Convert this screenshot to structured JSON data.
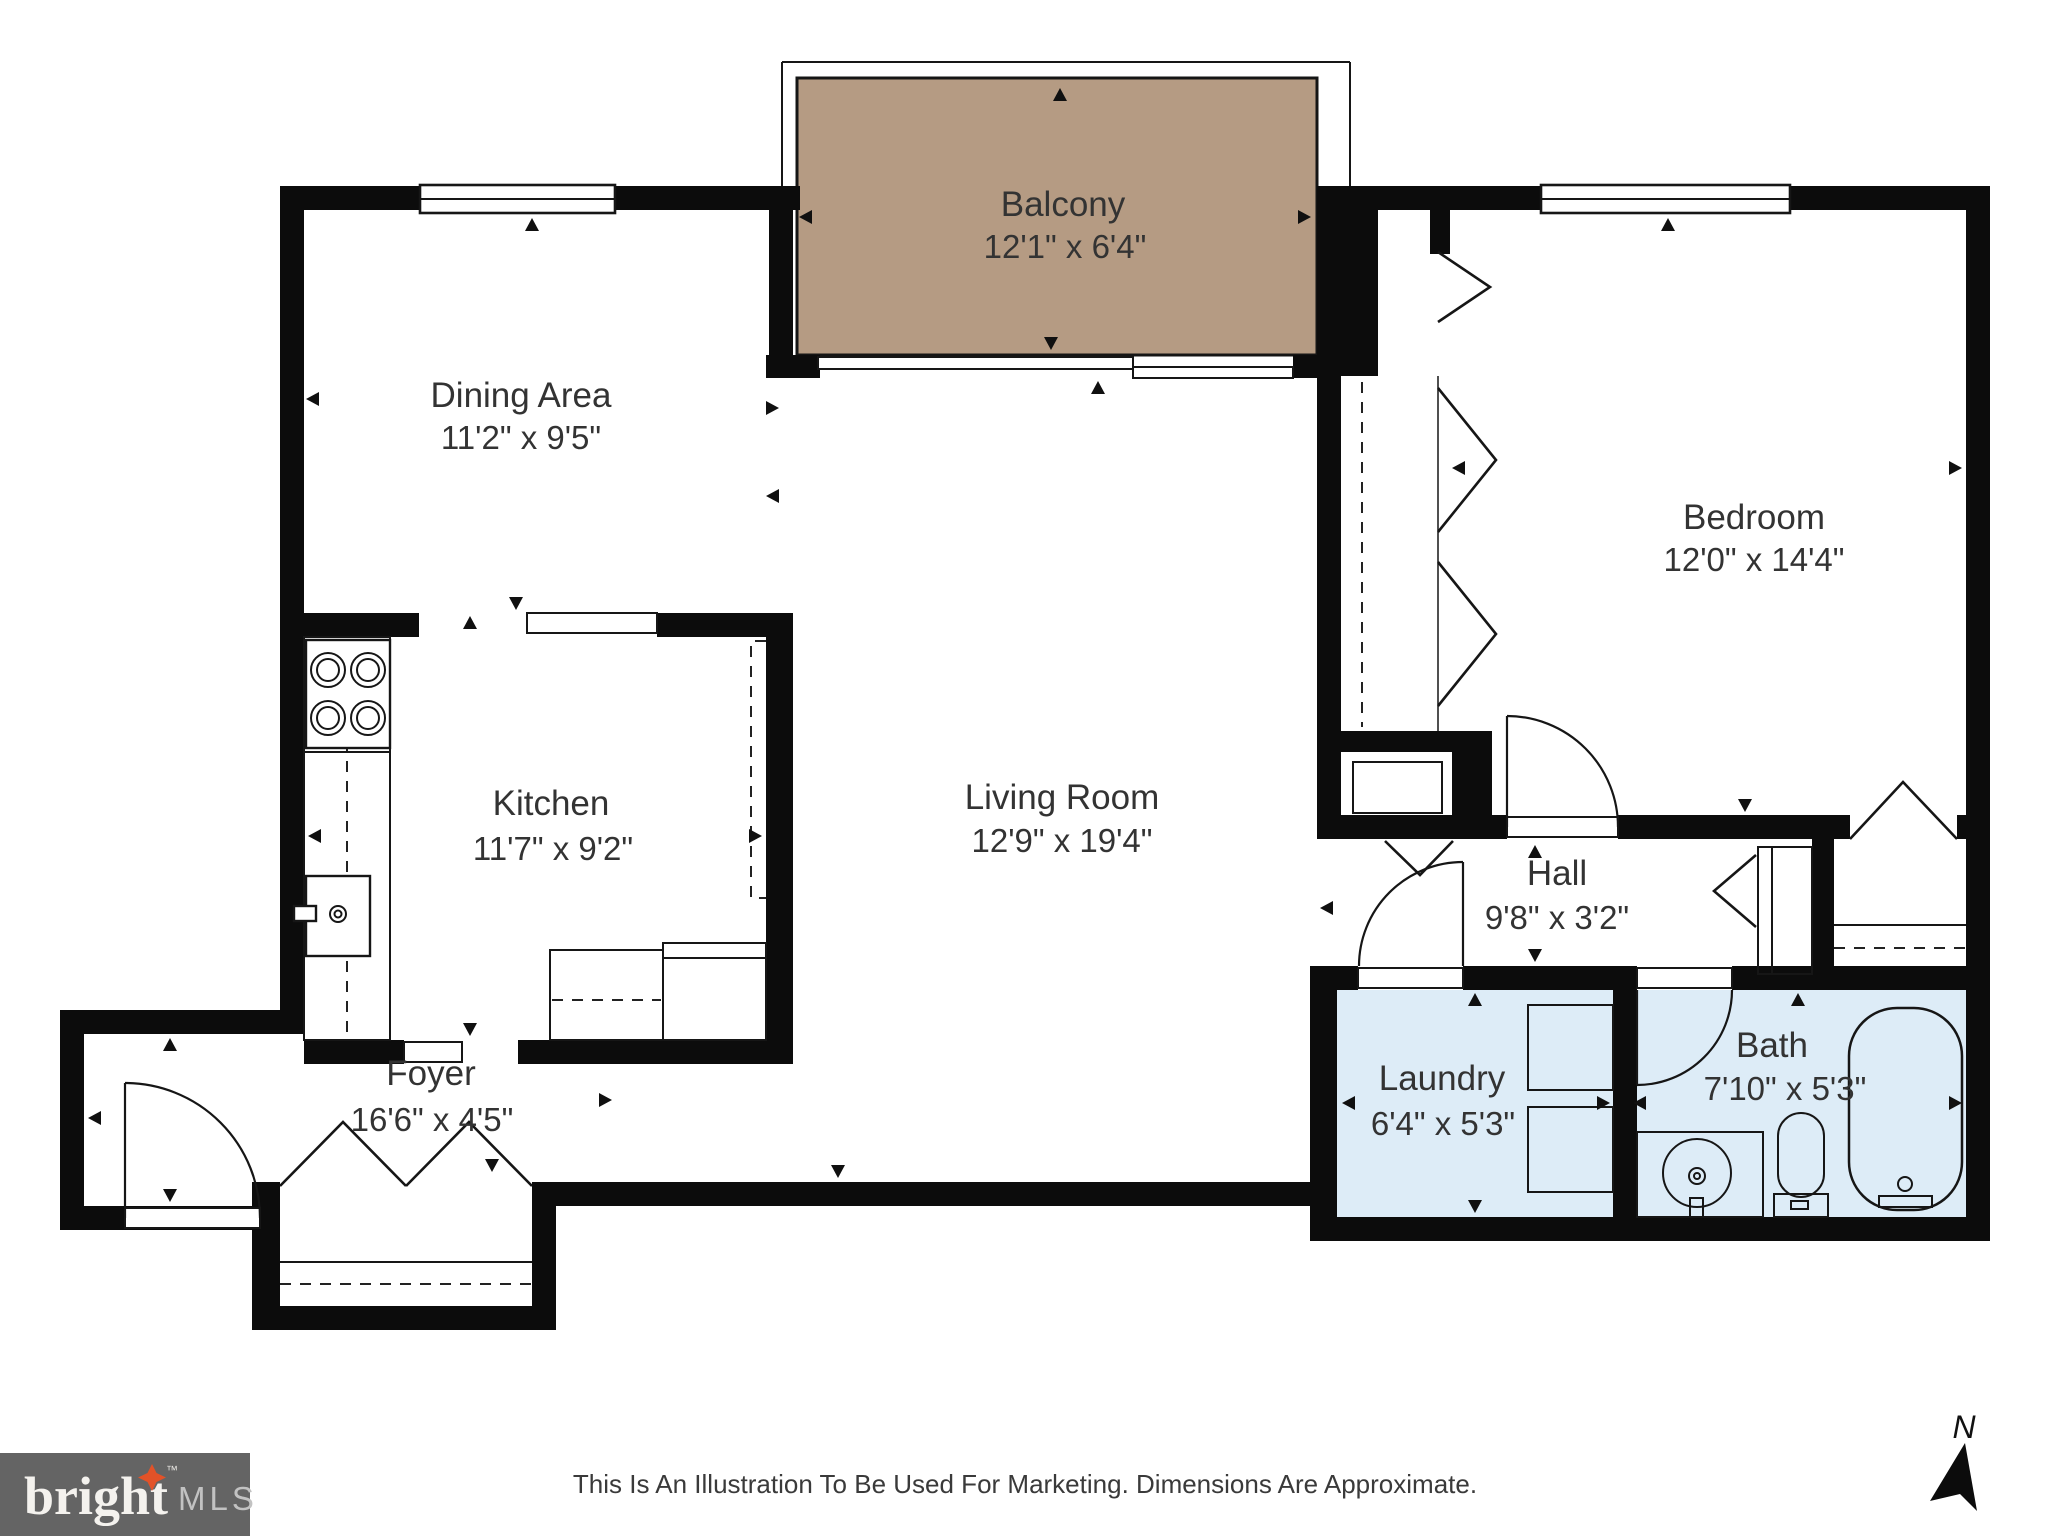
{
  "rooms": {
    "balcony": {
      "name": "Balcony",
      "dims": "12'1\" x 6'4\""
    },
    "dining": {
      "name": "Dining Area",
      "dims": "11'2\" x 9'5\""
    },
    "bedroom": {
      "name": "Bedroom",
      "dims": "12'0\" x 14'4\""
    },
    "kitchen": {
      "name": "Kitchen",
      "dims": "11'7\" x 9'2\""
    },
    "living": {
      "name": "Living Room",
      "dims": "12'9\" x 19'4\""
    },
    "hall": {
      "name": "Hall",
      "dims": "9'8\" x 3'2\""
    },
    "foyer": {
      "name": "Foyer",
      "dims": "16'6\" x 4'5\""
    },
    "laundry": {
      "name": "Laundry",
      "dims": "6'4\" x 5'3\""
    },
    "bath": {
      "name": "Bath",
      "dims": "7'10\" x 5'3\""
    }
  },
  "footer": {
    "brand": "bright",
    "brand_tm": "™",
    "brand_suffix": "MLS",
    "disclaimer": "This Is An Illustration To Be Used For Marketing. Dimensions Are Approximate.",
    "north_label": "N"
  },
  "colors": {
    "wall": "#0c0c0c",
    "balcony_fill": "#b59b83",
    "wet_room_fill": "#ddecf7",
    "logo_bar": "#646464",
    "logo_star": "#e25228",
    "logo_mls_text": "#c2c2c2",
    "label_text": "#333333"
  }
}
